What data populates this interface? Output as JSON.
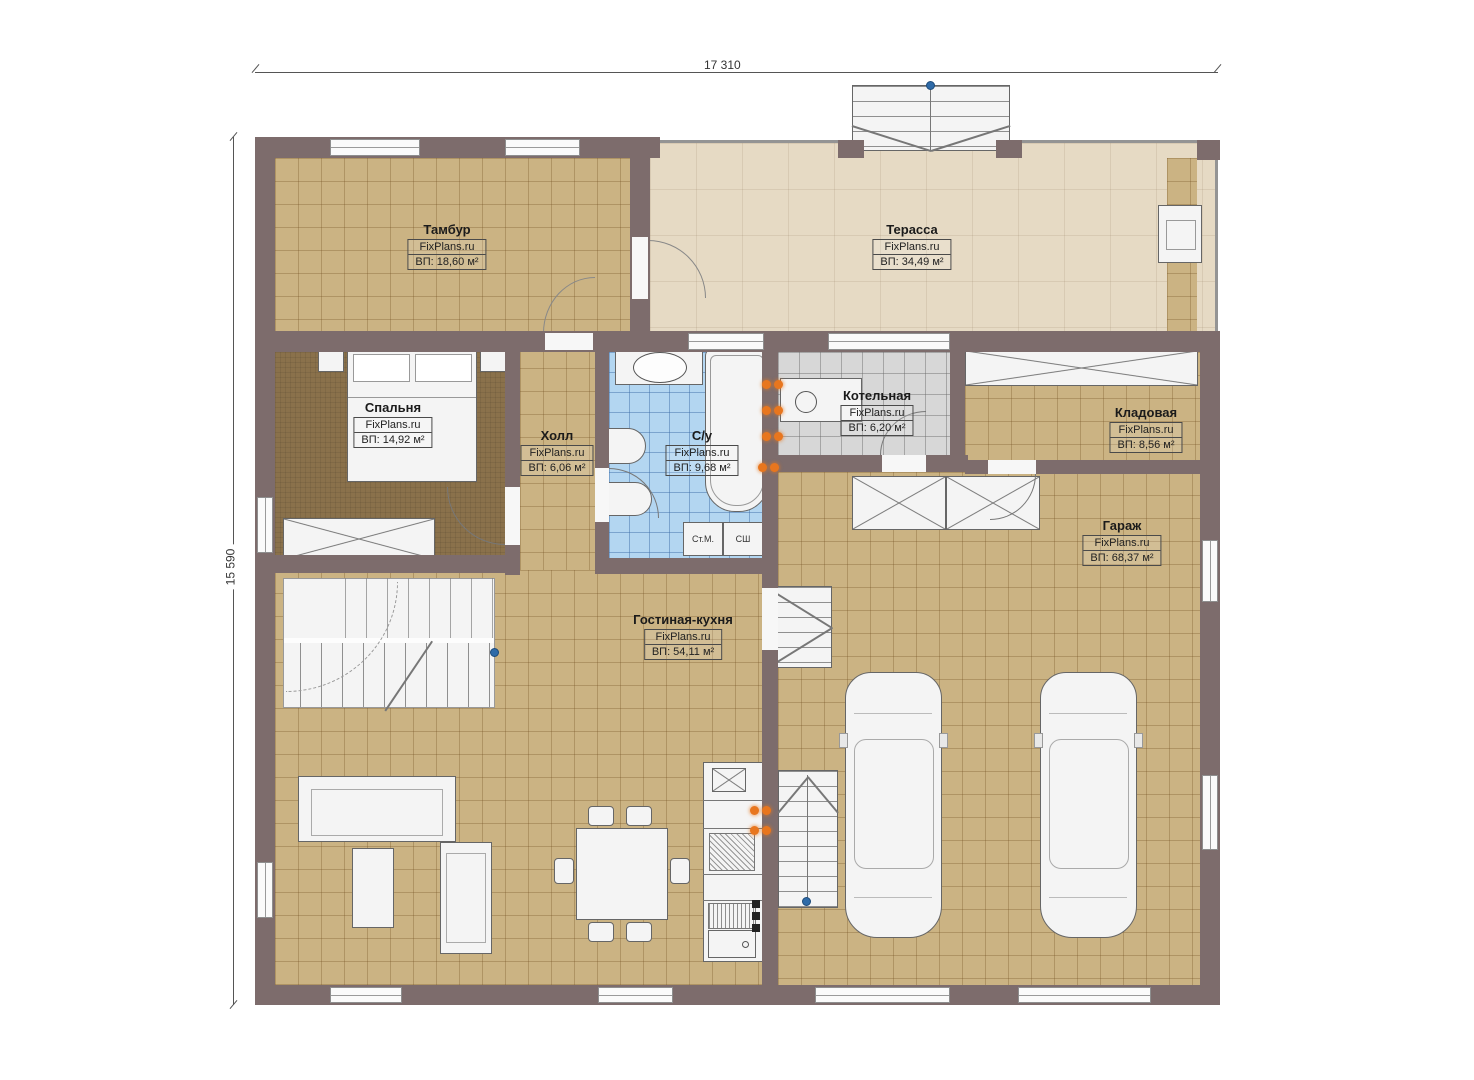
{
  "dimensions": {
    "top": "17 310",
    "left": "15 590"
  },
  "brand": "FixPlans.ru",
  "rooms": [
    {
      "name": "Тамбур",
      "brand": "FixPlans.ru",
      "area": "ВП: 18,60 м²"
    },
    {
      "name": "Терасса",
      "brand": "FixPlans.ru",
      "area": "ВП: 34,49 м²"
    },
    {
      "name": "Спальня",
      "brand": "FixPlans.ru",
      "area": "ВП: 14,92 м²"
    },
    {
      "name": "Холл",
      "brand": "FixPlans.ru",
      "area": "ВП: 6,06 м²"
    },
    {
      "name": "С/у",
      "brand": "FixPlans.ru",
      "area": "ВП: 9,68 м²"
    },
    {
      "name": "Котельная",
      "brand": "FixPlans.ru",
      "area": "ВП: 6,20 м²"
    },
    {
      "name": "Кладовая",
      "brand": "FixPlans.ru",
      "area": "ВП: 8,56 м²"
    },
    {
      "name": "Гараж",
      "brand": "FixPlans.ru",
      "area": "ВП: 68,37 м²"
    },
    {
      "name": "Гостиная-кухня",
      "brand": "FixPlans.ru",
      "area": "ВП: 54,11 м²"
    }
  ],
  "appliances": {
    "washer": "Ст.М.",
    "dryer": "СШ"
  },
  "colors": {
    "wall": "#7d6c6c",
    "floor_tile": "#cbb383",
    "bedroom_floor": "#8a714b",
    "terrace": "#e6dac4",
    "bath_tile": "#b3d6f1",
    "boiler_tile": "#d7d7d7",
    "fixture": "#f4f4f4",
    "radiator": "#e8761e",
    "marker_blue": "#2f6ba8"
  }
}
